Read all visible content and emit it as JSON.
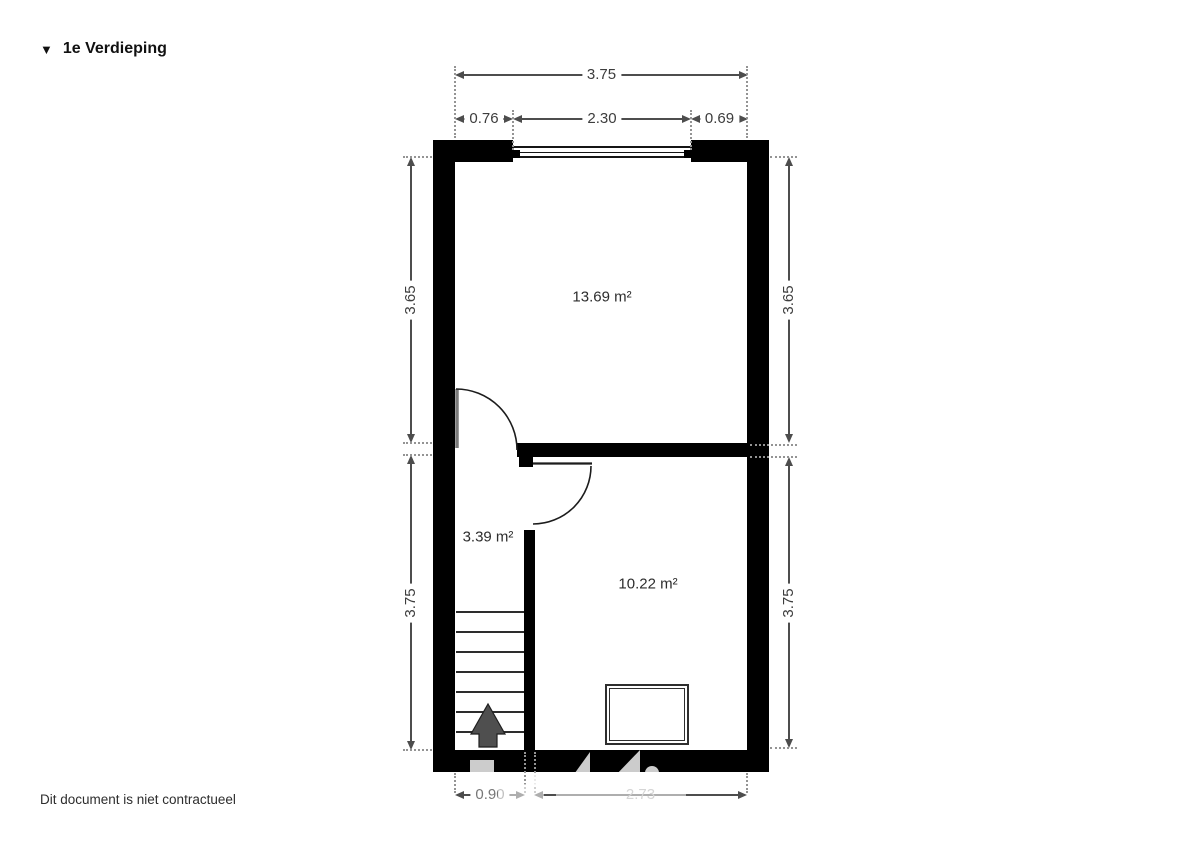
{
  "page": {
    "title_icon": "▼",
    "title": "1e Verdieping",
    "disclaimer": "Dit document is niet contractueel"
  },
  "rooms": {
    "room_top": {
      "area": "13.69 m²"
    },
    "hall": {
      "area": "3.39 m²"
    },
    "room_bottom": {
      "area": "10.22 m²"
    }
  },
  "dimensions": {
    "top_total": "3.75",
    "top_seg_left": "0.76",
    "top_seg_window": "2.30",
    "top_seg_right": "0.69",
    "left_upper": "3.65",
    "left_lower": "3.75",
    "right_upper": "3.65",
    "right_lower": "3.75",
    "bottom_seg_left": "0.90",
    "bottom_seg_right": "2.73"
  },
  "colors": {
    "wall": "#000000",
    "dimension_line": "#4d4d4d",
    "dimension_text": "#3d3d3d",
    "stair_arrow": "#4f4f4f"
  }
}
